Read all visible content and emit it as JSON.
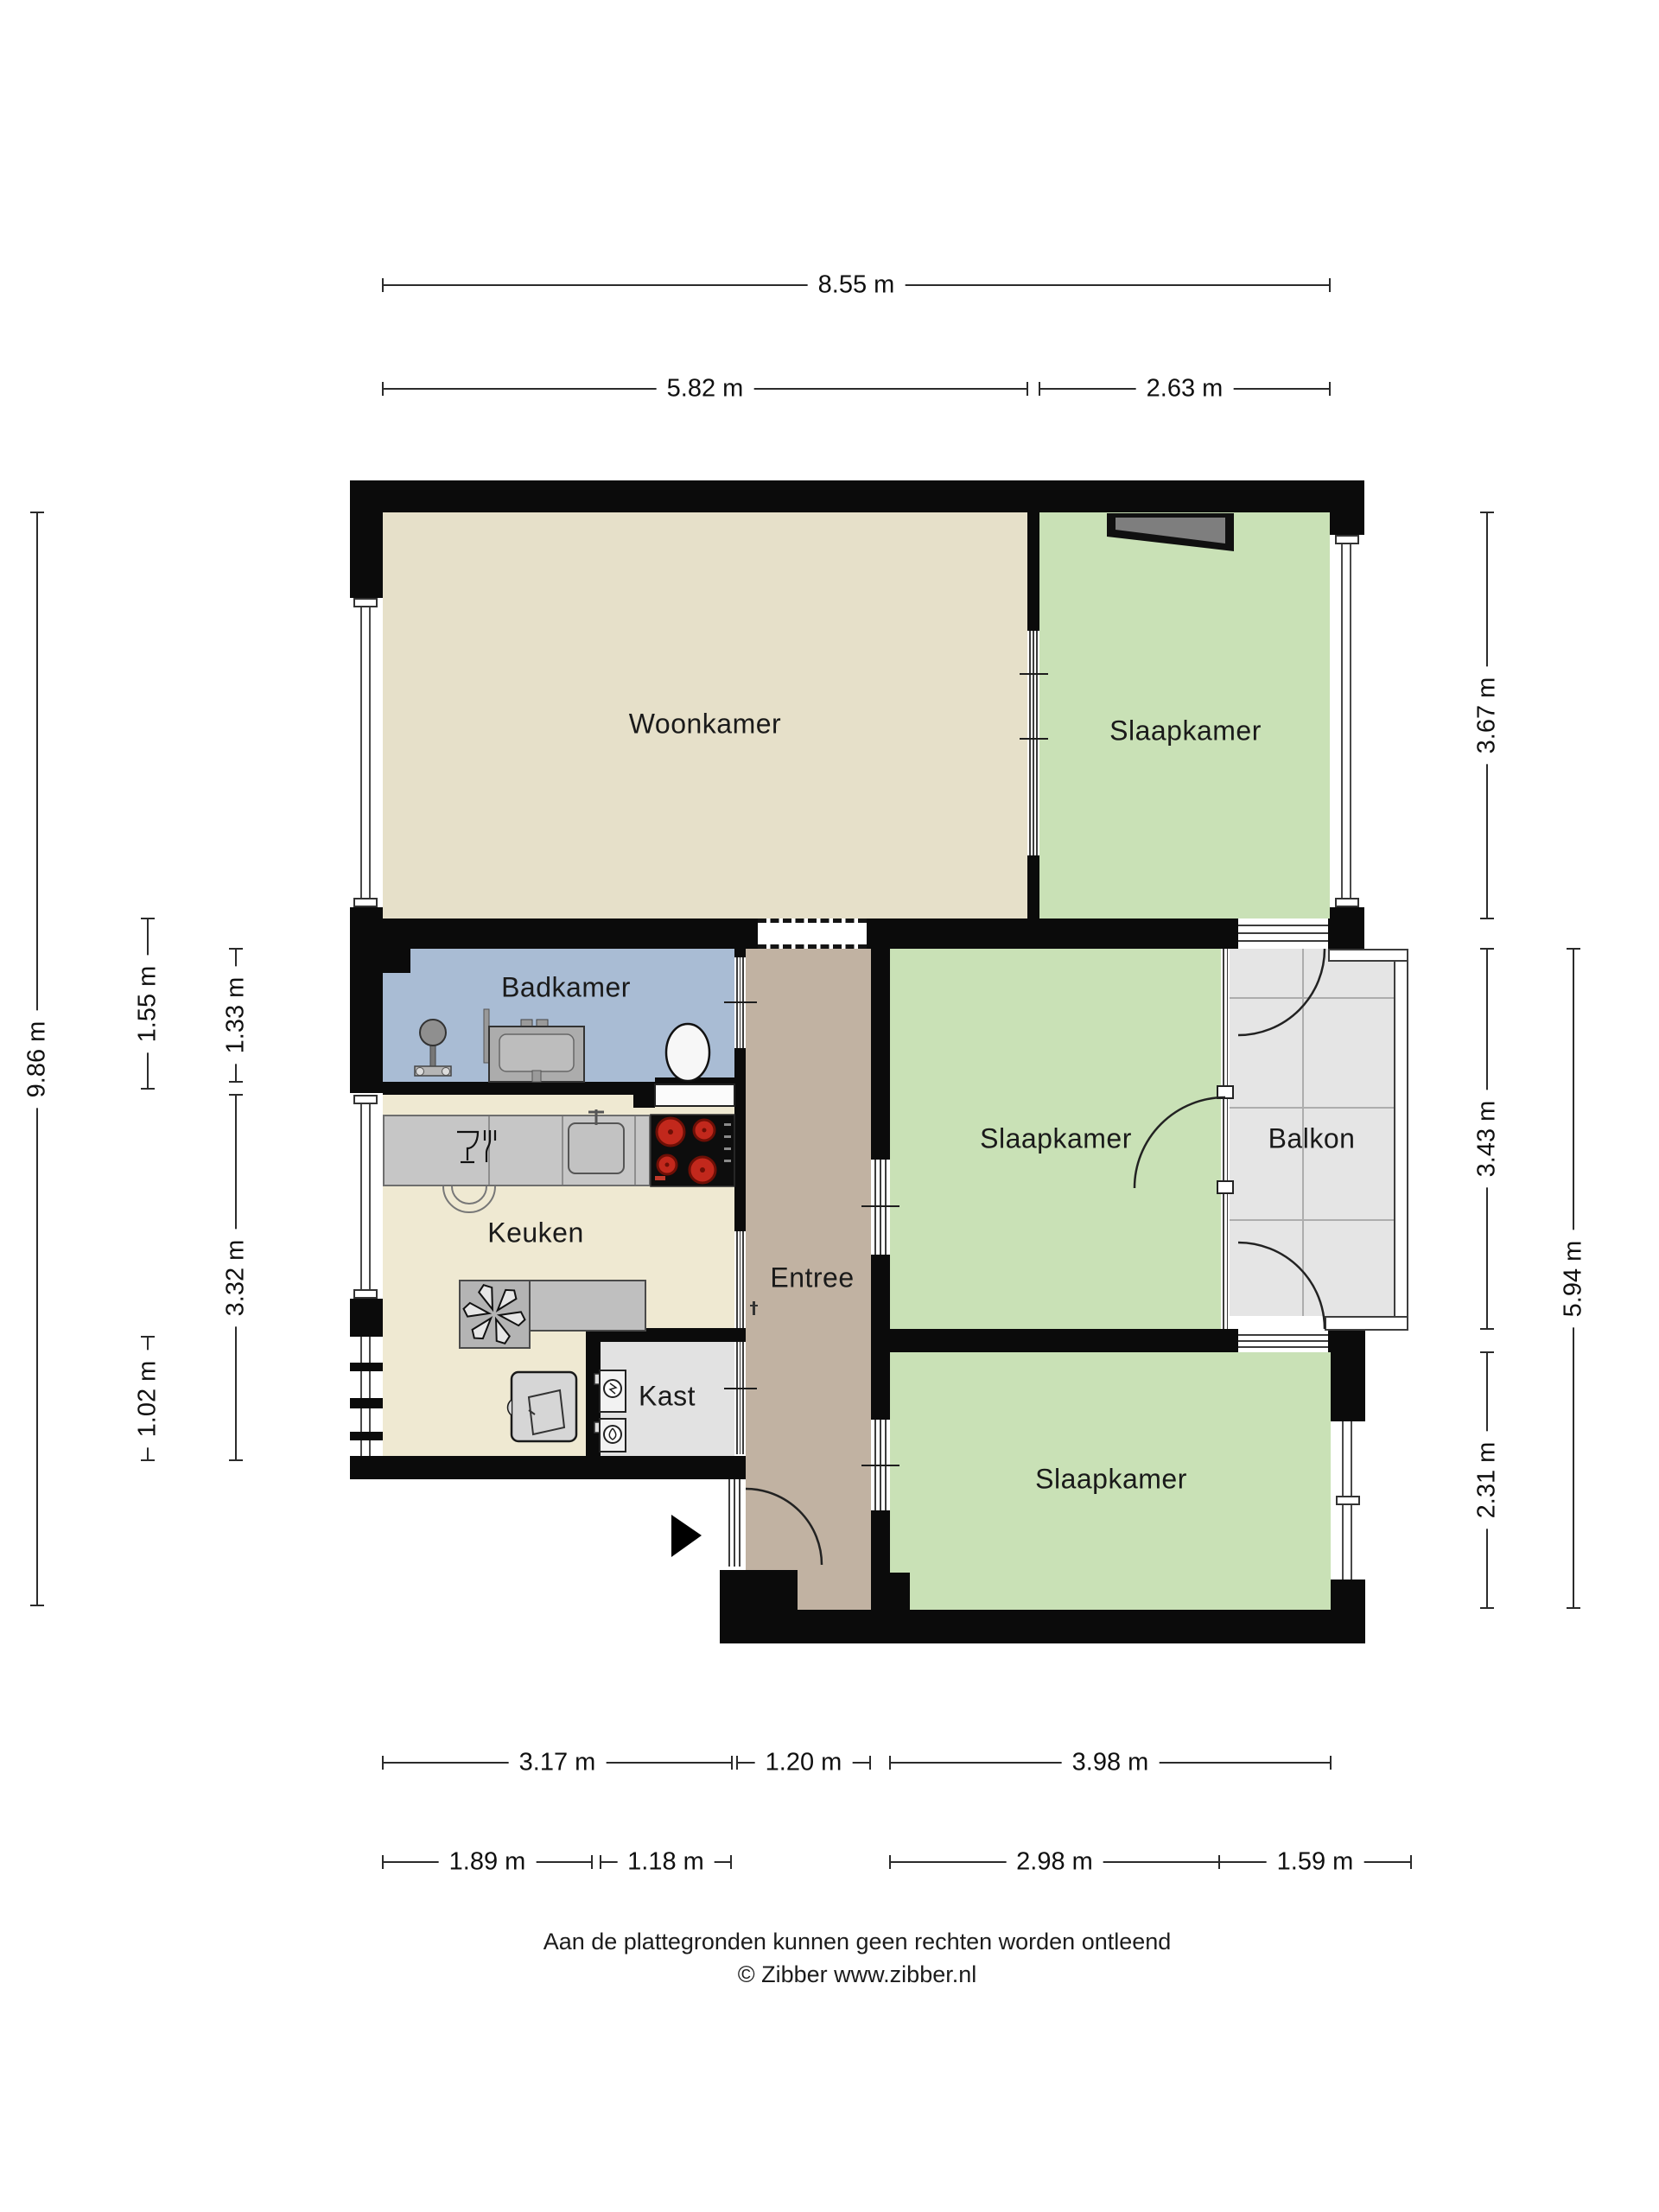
{
  "rooms": {
    "woonkamer": {
      "label": "Woonkamer"
    },
    "slaapkamer_top": {
      "label": "Slaapkamer"
    },
    "slaapkamer_middle": {
      "label": "Slaapkamer"
    },
    "slaapkamer_bottom": {
      "label": "Slaapkamer"
    },
    "badkamer": {
      "label": "Badkamer"
    },
    "keuken": {
      "label": "Keuken"
    },
    "entree": {
      "label": "Entree"
    },
    "kast": {
      "label": "Kast"
    },
    "balkon": {
      "label": "Balkon"
    }
  },
  "dimensions": {
    "top_total": "8.55 m",
    "top_left": "5.82 m",
    "top_right": "2.63 m",
    "left_total": "9.86 m",
    "left_badkamer_outer": "1.55 m",
    "left_badkamer_inner": "1.33 m",
    "left_keuken": "3.32 m",
    "left_window": "1.02 m",
    "right_top": "3.67 m",
    "right_middle": "3.43 m",
    "right_bottom": "2.31 m",
    "right_lower_total": "5.94 m",
    "bottom_keuken": "3.17 m",
    "bottom_entree": "1.20 m",
    "bottom_slaapkamer": "3.98 m",
    "bottom2_keuken": "1.89 m",
    "bottom2_kast": "1.18 m",
    "bottom2_slaapkamer": "2.98 m",
    "bottom2_balkon": "1.59 m"
  },
  "footer": {
    "disclaimer": "Aan de plattegronden kunnen geen rechten worden ontleend",
    "copyright": "© Zibber www.zibber.nl"
  },
  "colors": {
    "wall": "#0b0b0b",
    "woonkamer_floor": "#e6e0c9",
    "slaapkamer_floor": "#c9e1b6",
    "badkamer_floor": "#a9bcd4",
    "keuken_floor": "#efe9d2",
    "entree_floor": "#c1b2a2",
    "kast_floor": "#e2e2e2",
    "balkon_floor": "#e5e5e5",
    "counter": "#c6c6c6",
    "cooktop_burner": "#c2281c",
    "wardrobe": "#7e7e7e"
  },
  "icons": {
    "shower": "shower-icon",
    "vanity": "washbasin-icon",
    "toilet": "toilet-icon",
    "glassware": "glassware-icon",
    "kitchen_sink": "kitchen-sink-icon",
    "cooktop": "cooktop-icon",
    "ventilation": "ventilation-fan-icon",
    "fridge": "fridge-icon",
    "washer": "washer-icon",
    "dryer": "dryer-icon",
    "wardrobe": "wardrobe-icon",
    "entrance_arrow": "entrance-arrow-icon"
  }
}
